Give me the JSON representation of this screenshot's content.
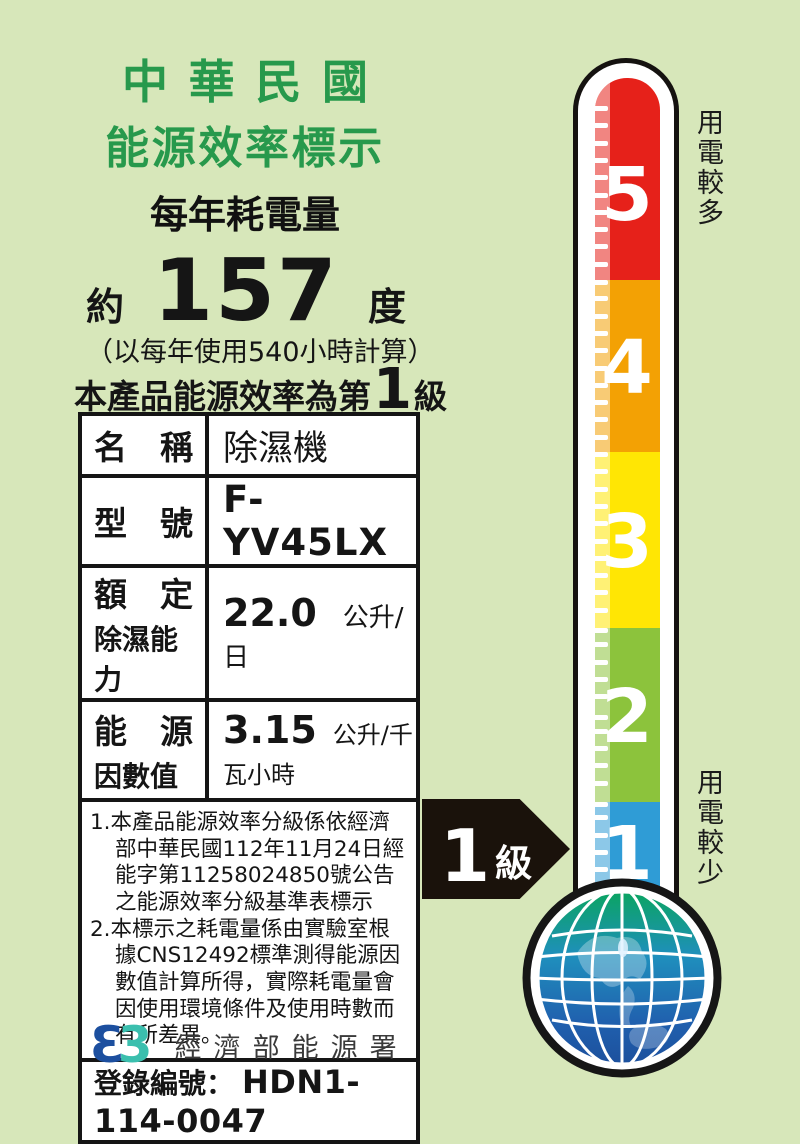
{
  "header": {
    "title_line1": "中華民國",
    "title_line2": "能源效率標示",
    "subtitle": "每年耗電量"
  },
  "consumption": {
    "prefix": "約",
    "value": "157",
    "unit": "度",
    "basis": "（以每年使用540小時計算）"
  },
  "grade_statement": {
    "prefix": "本產品能源效率為第",
    "grade": "1",
    "suffix": "級"
  },
  "spec_table": {
    "rows": [
      {
        "label": "名　稱",
        "value": "除濕機"
      },
      {
        "label": "型　號",
        "value": "F-YV45LX"
      },
      {
        "label_line1": "額　定",
        "label_line2": "除濕能力",
        "value": "22.0",
        "unit": "公升/日"
      },
      {
        "label_line1": "能　源",
        "label_line2": "因數值",
        "value": "3.15",
        "unit": "公升/千瓦小時"
      }
    ]
  },
  "notes": [
    "1.本產品能源效率分級係依經濟部中華民國112年11月24日經能字第11258024850號公告之能源效率分級基準表標示",
    "2.本標示之耗電量係由實驗室根據CNS12492標準測得能源因數值計算所得，實際耗電量會因使用環境條件及使用時數而有所差異。"
  ],
  "registration": {
    "label": "登錄編號：",
    "value": "HDN1-114-0047"
  },
  "footer": {
    "logo_left_glyph": "Ɛ",
    "logo_right_glyph": "3",
    "agency": "經濟部能源署"
  },
  "thermometer": {
    "top_label": "用電較多",
    "bottom_label": "用電較少",
    "segments": [
      {
        "label": "5",
        "color": "#e6211a"
      },
      {
        "label": "4",
        "color": "#f3a104"
      },
      {
        "label": "3",
        "color": "#ffe604"
      },
      {
        "label": "2",
        "color": "#8cc33c"
      },
      {
        "label": "1",
        "color": "#2f9cd6"
      }
    ]
  },
  "arrow": {
    "grade": "1",
    "suffix": "級"
  },
  "colors": {
    "background": "#d7e7ba",
    "title_green": "#27994c",
    "logo_blue": "#1c4f9f",
    "logo_teal": "#3bbfae"
  }
}
